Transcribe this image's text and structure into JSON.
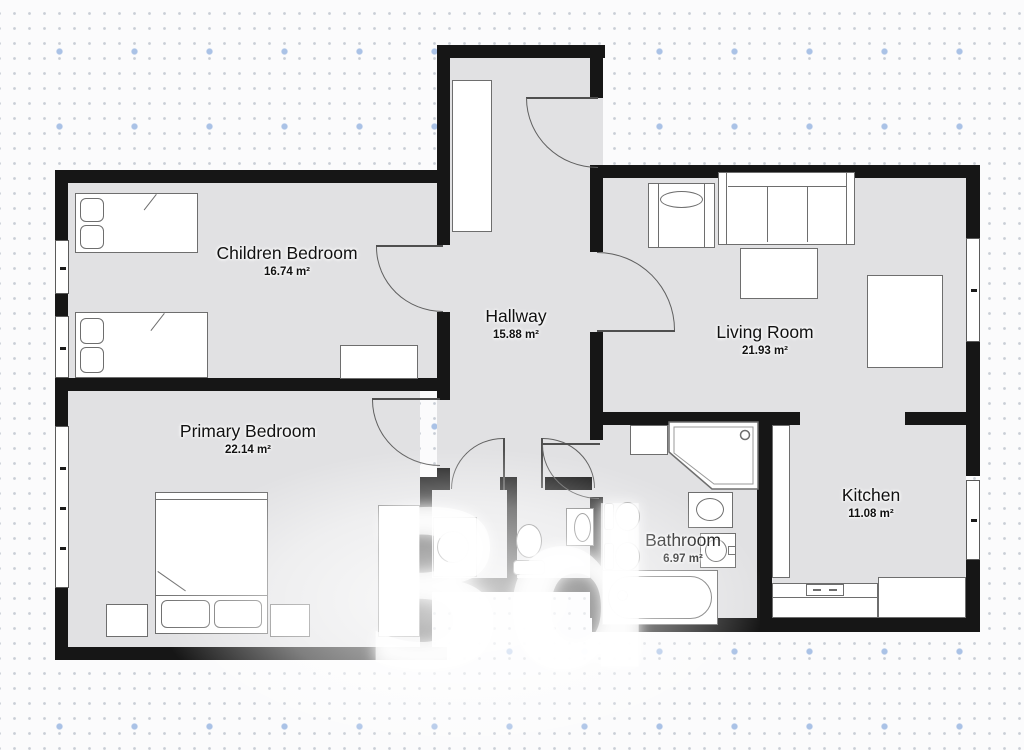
{
  "watermark": "3d",
  "rooms": [
    {
      "id": "children-bedroom",
      "name": "Children Bedroom",
      "area": "16.74 m²"
    },
    {
      "id": "primary-bedroom",
      "name": "Primary Bedroom",
      "area": "22.14 m²"
    },
    {
      "id": "hallway",
      "name": "Hallway",
      "area": "15.88 m²"
    },
    {
      "id": "living-room",
      "name": "Living Room",
      "area": "21.93 m²"
    },
    {
      "id": "kitchen",
      "name": "Kitchen",
      "area": "11.08 m²"
    },
    {
      "id": "bathroom",
      "name": "Bathroom",
      "area": "6.97 m²"
    }
  ],
  "icons": [
    "single-bed",
    "double-bed",
    "pillow",
    "nightstand",
    "wardrobe",
    "closet",
    "desk",
    "armchair",
    "sofa",
    "coffee-table",
    "side-table",
    "kitchen-counter",
    "stove",
    "toilet",
    "bidet",
    "bathtub",
    "corner-shower",
    "washing-machine",
    "sink",
    "door-swing",
    "window"
  ],
  "colors": {
    "wall": "#161616",
    "floor": "#e1e1e3",
    "furniture_outline": "#6e6e6e",
    "background": "#fbfbfc",
    "label": "#111111",
    "dot": "#c9ced6",
    "accent_dot": "#aac2e6"
  }
}
